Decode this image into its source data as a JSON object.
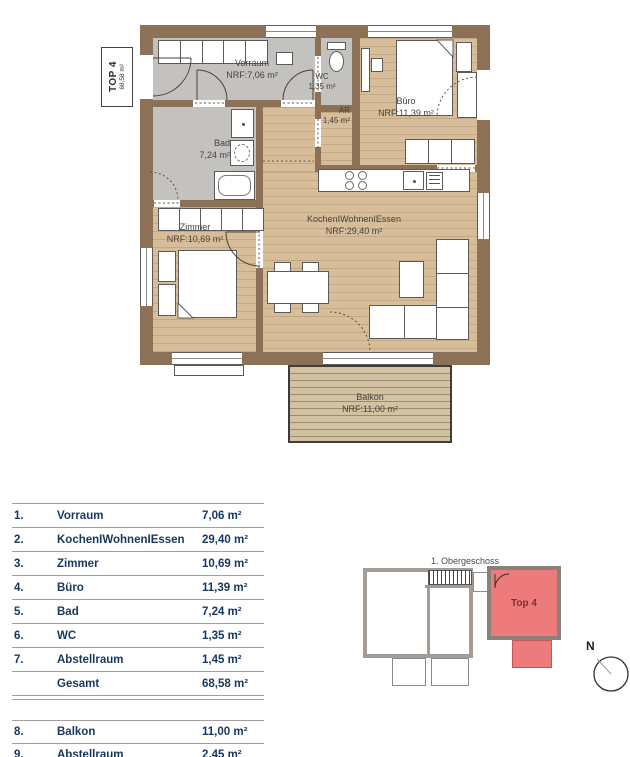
{
  "unit": {
    "name": "TOP 4",
    "total_area": "68,58 m²"
  },
  "plan": {
    "rooms": [
      {
        "id": "vorraum",
        "name": "Vorraum",
        "area": "NRF:7,06 m²"
      },
      {
        "id": "wc",
        "name": "WC",
        "area": "1,35 m²"
      },
      {
        "id": "ar",
        "name": "AR",
        "area": "1,45 m²"
      },
      {
        "id": "buero",
        "name": "Büro",
        "area": "NRF:11,39 m²"
      },
      {
        "id": "bad",
        "name": "Bad",
        "area": "7,24 m²"
      },
      {
        "id": "zimmer",
        "name": "Zimmer",
        "area": "NRF:10,69 m²"
      },
      {
        "id": "wohnen",
        "name": "KochenIWohnenIEssen",
        "area": "NRF:29,40 m²"
      },
      {
        "id": "balkon",
        "name": "Balkon",
        "area": "NRF:11,00 m²"
      }
    ]
  },
  "table": {
    "main_rows": [
      {
        "num": "1.",
        "label": "Vorraum",
        "value": "7,06 m²"
      },
      {
        "num": "2.",
        "label": "KochenIWohnenIEssen",
        "value": "29,40 m²"
      },
      {
        "num": "3.",
        "label": "Zimmer",
        "value": "10,69 m²"
      },
      {
        "num": "4.",
        "label": "Büro",
        "value": "11,39 m²"
      },
      {
        "num": "5.",
        "label": "Bad",
        "value": "7,24 m²"
      },
      {
        "num": "6.",
        "label": "WC",
        "value": "1,35 m²"
      },
      {
        "num": "7.",
        "label": "Abstellraum",
        "value": "1,45 m²"
      },
      {
        "num": "",
        "label": "Gesamt",
        "value": "68,58 m²"
      }
    ],
    "extra_rows": [
      {
        "num": "8.",
        "label": "Balkon",
        "value": "11,00 m²"
      },
      {
        "num": "9.",
        "label": "Abstellraum",
        "value": "2,45 m²"
      }
    ]
  },
  "overview": {
    "title": "1. Obergeschoss",
    "highlighted_unit": "Top 4",
    "compass": "N"
  },
  "colors": {
    "wall": "#8d7156",
    "wood_floor": "#d7bd99",
    "gray_floor": "#c4c2bf",
    "balcony_floor": "#d3c2a2",
    "highlight_red": "#ed7b7b",
    "table_text": "#17375d"
  }
}
